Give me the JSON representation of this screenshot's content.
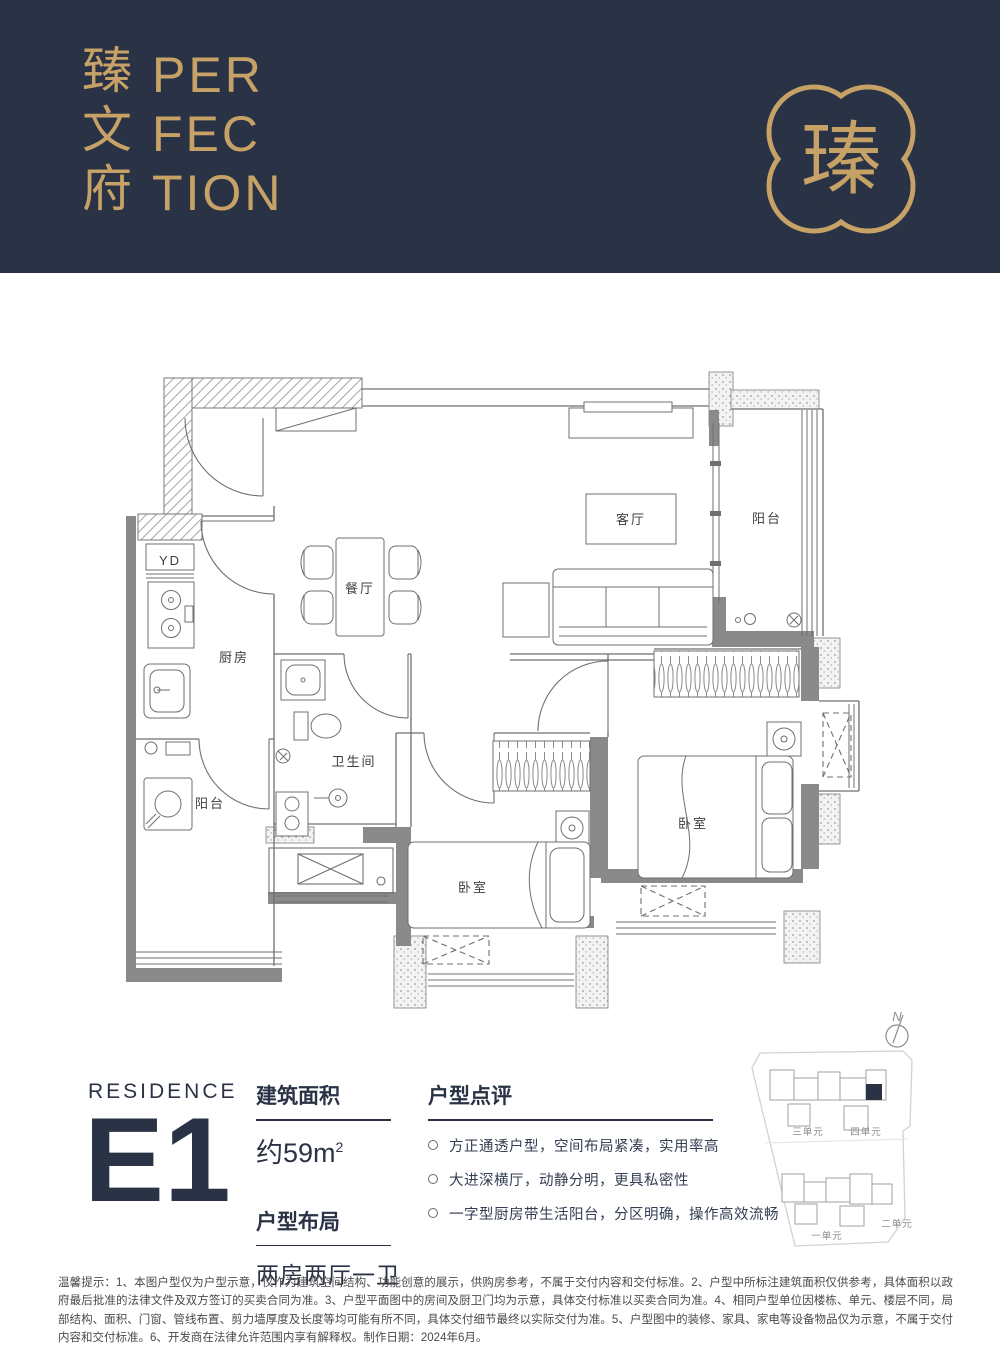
{
  "colors": {
    "navy": "#2A3245",
    "gold": "#C7A266"
  },
  "header": {
    "brand_cn": [
      "臻",
      "文",
      "府"
    ],
    "brand_en": [
      "PER",
      "FEC",
      "TION"
    ],
    "logo_glyph": "瑧"
  },
  "floorplan": {
    "labels": {
      "living": "客厅",
      "balcony": "阳台",
      "dining": "餐厅",
      "kitchen": "厨房",
      "bath": "卫生间",
      "service_balcony": "阳台",
      "bedroom_a": "卧室",
      "bedroom_b": "卧室",
      "yd": "YD"
    }
  },
  "info": {
    "residence": "RESIDENCE",
    "unit": "E1",
    "area_title": "建筑面积",
    "area_value": "约59m",
    "area_sup": "2",
    "layout_title": "户型布局",
    "layout_value": "两房两厅一卫",
    "review_title": "户型点评",
    "bullets": [
      "方正通透户型，空间布局紧凑，实用率高",
      "大进深横厅，动静分明，更具私密性",
      "一字型厨房带生活阳台，分区明确，操作高效流畅"
    ]
  },
  "sitemap": {
    "north": "N",
    "units": [
      "三单元",
      "四单元",
      "一单元",
      "二单元"
    ]
  },
  "disclaimer": "温馨提示：1、本图户型仅为户型示意，仅作为建筑空间结构、功能创意的展示，供购房参考，不属于交付内容和交付标准。2、户型中所标注建筑面积仅供参考，具体面积以政府最后批准的法律文件及双方签订的买卖合同为准。3、户型平面图中的房间及厨卫门均为示意，具体交付标准以买卖合同为准。4、相同户型单位因楼栋、单元、楼层不同，局部结构、面积、门窗、管线布置、剪力墙厚度及长度等均可能有所不同，具体交付细节最终以实际交付为准。5、户型图中的装修、家具、家电等设备物品仅为示意，不属于交付内容和交付标准。6、开发商在法律允许范围内享有解释权。制作日期：2024年6月。"
}
